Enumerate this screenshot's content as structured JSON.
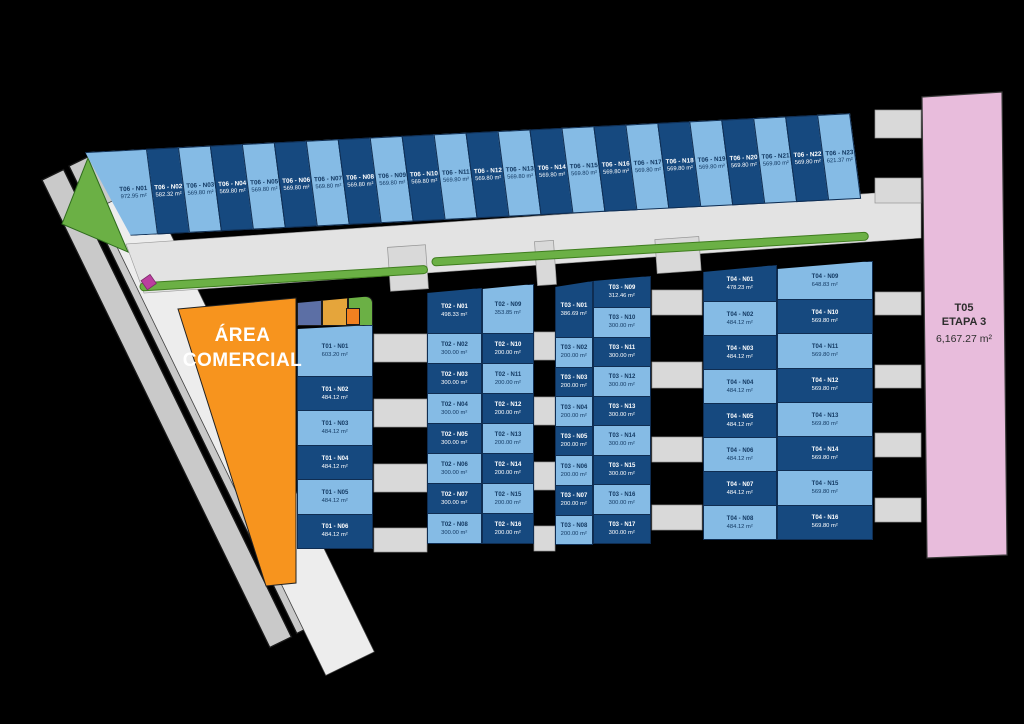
{
  "commercial": {
    "line1": "ÁREA",
    "line2": "COMERCIAL"
  },
  "t05": {
    "name": "T05",
    "stage": "ETAPA 3",
    "area": "6,167.27 m²"
  },
  "colors": {
    "lot_light": "#85bbe5",
    "lot_dark": "#16497f",
    "lot_border": "#0f2d52",
    "text_on_light": "#143a63",
    "text_on_dark": "#ffffff",
    "road": "#e3e3e3",
    "pad": "#d9d9d9",
    "diagonal_road": "#c9c9c9",
    "diagonal_road_wide": "#ededed",
    "green": "#6bb045",
    "orange_area": "#f7941e",
    "orange_block": "#f28020",
    "pink_area": "#e8bcdc",
    "magenta": "#bb3f9f",
    "slate_block": "#5c6fa5",
    "yellow_block": "#e5a53b"
  },
  "blocks": {
    "t06": {
      "label": "T06",
      "lots": [
        {
          "id": "T06 - N01",
          "area": "972.95 m²",
          "shade": "light"
        },
        {
          "id": "T06 - N02",
          "area": "582.32 m²",
          "shade": "dark"
        },
        {
          "id": "T06 - N03",
          "area": "569.80 m²",
          "shade": "light"
        },
        {
          "id": "T06 - N04",
          "area": "569.80 m²",
          "shade": "dark"
        },
        {
          "id": "T06 - N05",
          "area": "569.80 m²",
          "shade": "light"
        },
        {
          "id": "T06 - N06",
          "area": "569.80 m²",
          "shade": "dark"
        },
        {
          "id": "T06 - N07",
          "area": "569.80 m²",
          "shade": "light"
        },
        {
          "id": "T06 - N08",
          "area": "569.80 m²",
          "shade": "dark"
        },
        {
          "id": "T06 - N09",
          "area": "569.80 m²",
          "shade": "light"
        },
        {
          "id": "T06 - N10",
          "area": "569.80 m²",
          "shade": "dark"
        },
        {
          "id": "T06 - N11",
          "area": "569.80 m²",
          "shade": "light"
        },
        {
          "id": "T06 - N12",
          "area": "569.80 m²",
          "shade": "dark"
        },
        {
          "id": "T06 - N13",
          "area": "569.80 m²",
          "shade": "light"
        },
        {
          "id": "T06 - N14",
          "area": "569.80 m²",
          "shade": "dark"
        },
        {
          "id": "T06 - N15",
          "area": "569.80 m²",
          "shade": "light"
        },
        {
          "id": "T06 - N16",
          "area": "569.80 m²",
          "shade": "dark"
        },
        {
          "id": "T06 - N17",
          "area": "569.80 m²",
          "shade": "light"
        },
        {
          "id": "T06 - N18",
          "area": "569.80 m²",
          "shade": "dark"
        },
        {
          "id": "T06 - N19",
          "area": "569.80 m²",
          "shade": "light"
        },
        {
          "id": "T06 - N20",
          "area": "569.80 m²",
          "shade": "dark"
        },
        {
          "id": "T06 - N21",
          "area": "569.80 m²",
          "shade": "light"
        },
        {
          "id": "T06 - N22",
          "area": "569.80 m²",
          "shade": "dark"
        },
        {
          "id": "T06 - N23",
          "area": "621.37 m²",
          "shade": "light"
        }
      ]
    },
    "t01": {
      "label": "T01",
      "lots": [
        {
          "id": "T01 - N01",
          "area": "603.20 m²",
          "shade": "light"
        },
        {
          "id": "T01 - N02",
          "area": "484.12 m²",
          "shade": "dark"
        },
        {
          "id": "T01 - N03",
          "area": "484.12 m²",
          "shade": "light"
        },
        {
          "id": "T01 - N04",
          "area": "484.12 m²",
          "shade": "dark"
        },
        {
          "id": "T01 - N05",
          "area": "484.12 m²",
          "shade": "light"
        },
        {
          "id": "T01 - N06",
          "area": "484.12 m²",
          "shade": "dark"
        }
      ]
    },
    "t02_left": {
      "label": "T02",
      "lots": [
        {
          "id": "T02 - N01",
          "area": "498.33 m²",
          "shade": "dark"
        },
        {
          "id": "T02 - N02",
          "area": "300.00 m²",
          "shade": "light"
        },
        {
          "id": "T02 - N03",
          "area": "300.00 m²",
          "shade": "dark"
        },
        {
          "id": "T02 - N04",
          "area": "300.00 m²",
          "shade": "light"
        },
        {
          "id": "T02 - N05",
          "area": "300.00 m²",
          "shade": "dark"
        },
        {
          "id": "T02 - N06",
          "area": "300.00 m²",
          "shade": "light"
        },
        {
          "id": "T02 - N07",
          "area": "300.00 m²",
          "shade": "dark"
        },
        {
          "id": "T02 - N08",
          "area": "300.00 m²",
          "shade": "light"
        }
      ]
    },
    "t02_right": {
      "label": "T02",
      "lots": [
        {
          "id": "T02 - N09",
          "area": "353.85 m²",
          "shade": "light"
        },
        {
          "id": "T02 - N10",
          "area": "200.00 m²",
          "shade": "dark"
        },
        {
          "id": "T02 - N11",
          "area": "200.00 m²",
          "shade": "light"
        },
        {
          "id": "T02 - N12",
          "area": "200.00 m²",
          "shade": "dark"
        },
        {
          "id": "T02 - N13",
          "area": "200.00 m²",
          "shade": "light"
        },
        {
          "id": "T02 - N14",
          "area": "200.00 m²",
          "shade": "dark"
        },
        {
          "id": "T02 - N15",
          "area": "200.00 m²",
          "shade": "light"
        },
        {
          "id": "T02 - N16",
          "area": "200.00 m²",
          "shade": "dark"
        }
      ]
    },
    "t03_left": {
      "label": "T03",
      "lots": [
        {
          "id": "T03 - N01",
          "area": "386.69 m²",
          "shade": "dark"
        },
        {
          "id": "T03 - N02",
          "area": "200.00 m²",
          "shade": "light"
        },
        {
          "id": "T03 - N03",
          "area": "200.00 m²",
          "shade": "dark"
        },
        {
          "id": "T03 - N04",
          "area": "200.00 m²",
          "shade": "light"
        },
        {
          "id": "T03 - N05",
          "area": "200.00 m²",
          "shade": "dark"
        },
        {
          "id": "T03 - N06",
          "area": "200.00 m²",
          "shade": "light"
        },
        {
          "id": "T03 - N07",
          "area": "200.00 m²",
          "shade": "dark"
        },
        {
          "id": "T03 - N08",
          "area": "200.00 m²",
          "shade": "light"
        }
      ]
    },
    "t03_right": {
      "label": "T03",
      "lots": [
        {
          "id": "T03 - N09",
          "area": "312.46 m²",
          "shade": "dark"
        },
        {
          "id": "T03 - N10",
          "area": "300.00 m²",
          "shade": "light"
        },
        {
          "id": "T03 - N11",
          "area": "300.00 m²",
          "shade": "dark"
        },
        {
          "id": "T03 - N12",
          "area": "300.00 m²",
          "shade": "light"
        },
        {
          "id": "T03 - N13",
          "area": "300.00 m²",
          "shade": "dark"
        },
        {
          "id": "T03 - N14",
          "area": "300.00 m²",
          "shade": "light"
        },
        {
          "id": "T03 - N15",
          "area": "300.00 m²",
          "shade": "dark"
        },
        {
          "id": "T03 - N16",
          "area": "300.00 m²",
          "shade": "light"
        },
        {
          "id": "T03 - N17",
          "area": "300.00 m²",
          "shade": "dark"
        }
      ]
    },
    "t04_left": {
      "label": "T04",
      "lots": [
        {
          "id": "T04 - N01",
          "area": "478.23 m²",
          "shade": "dark"
        },
        {
          "id": "T04 - N02",
          "area": "484.12 m²",
          "shade": "light"
        },
        {
          "id": "T04 - N03",
          "area": "484.12 m²",
          "shade": "dark"
        },
        {
          "id": "T04 - N04",
          "area": "484.12 m²",
          "shade": "light"
        },
        {
          "id": "T04 - N05",
          "area": "484.12 m²",
          "shade": "dark"
        },
        {
          "id": "T04 - N06",
          "area": "484.12 m²",
          "shade": "light"
        },
        {
          "id": "T04 - N07",
          "area": "484.12 m²",
          "shade": "dark"
        },
        {
          "id": "T04 - N08",
          "area": "484.12 m²",
          "shade": "light"
        }
      ]
    },
    "t04_right": {
      "label": "T04",
      "lots": [
        {
          "id": "T04 - N09",
          "area": "648.83 m²",
          "shade": "light"
        },
        {
          "id": "T04 - N10",
          "area": "569.80 m²",
          "shade": "dark"
        },
        {
          "id": "T04 - N11",
          "area": "569.80 m²",
          "shade": "light"
        },
        {
          "id": "T04 - N12",
          "area": "569.80 m²",
          "shade": "dark"
        },
        {
          "id": "T04 - N13",
          "area": "569.80 m²",
          "shade": "light"
        },
        {
          "id": "T04 - N14",
          "area": "569.80 m²",
          "shade": "dark"
        },
        {
          "id": "T04 - N15",
          "area": "569.80 m²",
          "shade": "light"
        },
        {
          "id": "T04 - N16",
          "area": "569.80 m²",
          "shade": "dark"
        }
      ]
    }
  }
}
